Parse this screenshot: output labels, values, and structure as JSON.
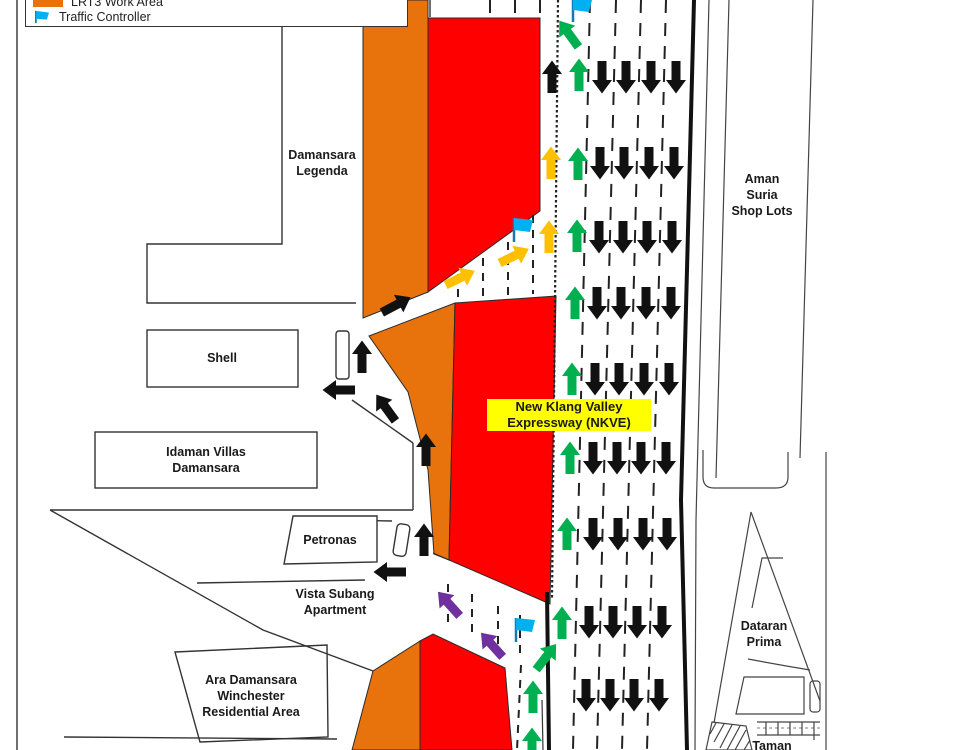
{
  "legend": {
    "items": [
      {
        "id": "work-area",
        "label": "LRT3 Work Area"
      },
      {
        "id": "traffic-controller",
        "label": "Traffic Controller"
      }
    ]
  },
  "colors": {
    "work_area_orange": "#E8720C",
    "closed_area_red": "#FF0000",
    "highway_label_yellow": "#FFFF00",
    "arrow_black": "#111111",
    "arrow_green": "#00B050",
    "arrow_yellow": "#FFC000",
    "arrow_purple": "#7030A0",
    "flag_blue": "#00B0F0"
  },
  "labels": [
    {
      "id": "damansara-legenda",
      "lines": [
        "Damansara",
        "Legenda"
      ],
      "cx": 322,
      "cy": 163,
      "w": 120
    },
    {
      "id": "shell",
      "lines": [
        "Shell"
      ],
      "cx": 222,
      "cy": 358,
      "w": 70
    },
    {
      "id": "idaman-villas-damansara",
      "lines": [
        "Idaman Villas",
        "Damansara"
      ],
      "cx": 206,
      "cy": 460,
      "w": 140
    },
    {
      "id": "petronas",
      "lines": [
        "Petronas"
      ],
      "cx": 330,
      "cy": 540,
      "w": 90
    },
    {
      "id": "vista-subang-apartment",
      "lines": [
        "Vista Subang",
        "Apartment"
      ],
      "cx": 335,
      "cy": 602,
      "w": 130
    },
    {
      "id": "ara-damansara-winchester",
      "lines": [
        "Ara Damansara",
        "Winchester",
        "Residential Area"
      ],
      "cx": 251,
      "cy": 696,
      "w": 160
    },
    {
      "id": "aman-suria-shop-lots",
      "lines": [
        "Aman",
        "Suria",
        "Shop Lots"
      ],
      "cx": 762,
      "cy": 195,
      "w": 110
    },
    {
      "id": "dataran-prima",
      "lines": [
        "Dataran",
        "Prima"
      ],
      "cx": 764,
      "cy": 634,
      "w": 90
    },
    {
      "id": "taman",
      "lines": [
        "Taman"
      ],
      "cx": 772,
      "cy": 746,
      "w": 70
    },
    {
      "id": "nkve",
      "lines": [
        "New Klang Valley",
        "Expressway (NKVE)"
      ],
      "cx": 569,
      "cy": 420,
      "w": 164,
      "box": "yellow"
    }
  ],
  "markers": {
    "flags": [
      {
        "id": "traffic-controller-top",
        "x": 573,
        "y": -2
      },
      {
        "id": "traffic-controller-middle",
        "x": 514,
        "y": 218
      },
      {
        "id": "traffic-controller-bottom",
        "x": 516,
        "y": 618
      }
    ],
    "arrows": [
      {
        "color": "black",
        "x": 552,
        "y": 77,
        "r": 0
      },
      {
        "color": "yellow",
        "x": 551,
        "y": 163,
        "r": 0
      },
      {
        "color": "yellow",
        "x": 549,
        "y": 237,
        "r": 0
      },
      {
        "color": "yellow",
        "x": 460,
        "y": 278,
        "r": 64
      },
      {
        "color": "yellow",
        "x": 514,
        "y": 256,
        "r": 64
      },
      {
        "color": "green",
        "x": 569,
        "y": 34,
        "r": -36
      },
      {
        "color": "green",
        "x": 579,
        "y": 75,
        "r": 0
      },
      {
        "color": "green",
        "x": 578,
        "y": 164,
        "r": 0
      },
      {
        "color": "green",
        "x": 577,
        "y": 236,
        "r": 0
      },
      {
        "color": "green",
        "x": 575,
        "y": 303,
        "r": 0
      },
      {
        "color": "green",
        "x": 572,
        "y": 379,
        "r": 0
      },
      {
        "color": "green",
        "x": 570,
        "y": 458,
        "r": 0
      },
      {
        "color": "green",
        "x": 567,
        "y": 534,
        "r": 0
      },
      {
        "color": "green",
        "x": 562,
        "y": 623,
        "r": 0
      },
      {
        "color": "green",
        "x": 546,
        "y": 657,
        "r": 38
      },
      {
        "color": "green",
        "x": 533,
        "y": 697,
        "r": 0
      },
      {
        "color": "green",
        "x": 532,
        "y": 744,
        "r": 0
      },
      {
        "color": "black",
        "x": 396,
        "y": 305,
        "r": 62
      },
      {
        "color": "black",
        "x": 362,
        "y": 357,
        "r": 0
      },
      {
        "color": "black",
        "x": 339,
        "y": 390,
        "r": -90
      },
      {
        "color": "black",
        "x": 386,
        "y": 408,
        "r": -36
      },
      {
        "color": "black",
        "x": 426,
        "y": 450,
        "r": 0
      },
      {
        "color": "black",
        "x": 424,
        "y": 540,
        "r": 0
      },
      {
        "color": "black",
        "x": 390,
        "y": 572,
        "r": -90
      },
      {
        "color": "purple",
        "x": 449,
        "y": 604,
        "r": -42
      },
      {
        "color": "purple",
        "x": 492,
        "y": 645,
        "r": -42
      }
    ],
    "down_rows": [
      {
        "y": 77,
        "xs": [
          602,
          626,
          651,
          676
        ]
      },
      {
        "y": 163,
        "xs": [
          600,
          624,
          649,
          674
        ]
      },
      {
        "y": 237,
        "xs": [
          599,
          623,
          647,
          672
        ]
      },
      {
        "y": 303,
        "xs": [
          597,
          621,
          646,
          671
        ]
      },
      {
        "y": 379,
        "xs": [
          595,
          619,
          644,
          669
        ]
      },
      {
        "y": 458,
        "xs": [
          593,
          617,
          641,
          666
        ]
      },
      {
        "y": 534,
        "xs": [
          593,
          618,
          643,
          667
        ]
      },
      {
        "y": 622,
        "xs": [
          589,
          613,
          637,
          662
        ]
      },
      {
        "y": 695,
        "xs": [
          586,
          610,
          634,
          659
        ]
      }
    ]
  }
}
